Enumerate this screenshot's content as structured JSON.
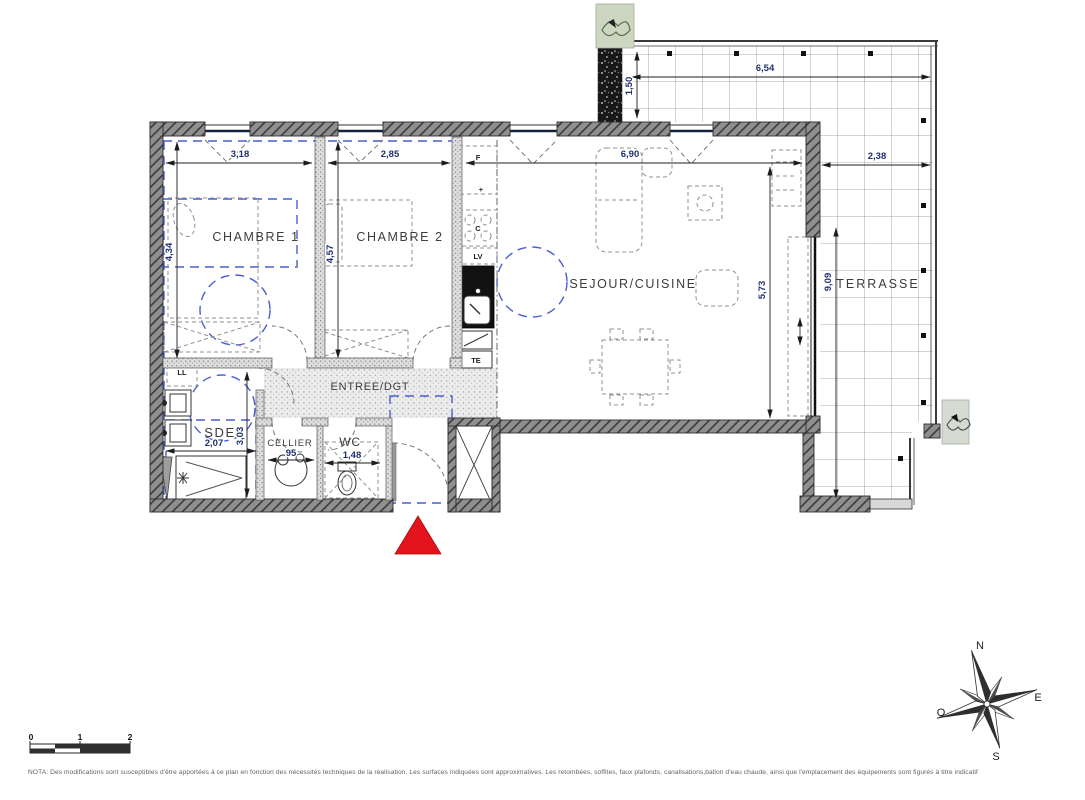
{
  "colors": {
    "wall": "#3a3a3a",
    "dimension_text": "#20306e",
    "accessibility_blue": "#4a5ed2",
    "entrance_marker_red": "#e3131b",
    "terrace_grid": "#8f8f8f"
  },
  "rooms": {
    "chambre1": {
      "label": "CHAMBRE 1",
      "width_m": "3,18",
      "height_m": "4,34"
    },
    "chambre2": {
      "label": "CHAMBRE 2",
      "width_m": "2,85",
      "height_m": "4,57"
    },
    "sejour_cuisine": {
      "label": "SEJOUR/CUISINE",
      "width_m": "6,90",
      "height_m": "5,73"
    },
    "entree": {
      "label": "ENTREE/DGT"
    },
    "sde": {
      "label": "SDE",
      "width_m": "2,07",
      "height_m": "3,03"
    },
    "cellier": {
      "label": "CELLIER",
      "width_cm": "95"
    },
    "wc": {
      "label": "WC",
      "width_m": "1,48"
    },
    "terrasse": {
      "label": "TERRASSE",
      "top_width_m": "6,54",
      "top_depth_m": "1,50",
      "side_width_m": "2,38",
      "side_length_m": "9,09"
    }
  },
  "appliances": {
    "fridge": "F",
    "plus": "+",
    "hob": "C",
    "dishwasher": "LV",
    "electrical_panel": "TE",
    "washing_machine": "LL"
  },
  "compass": {
    "north": "N",
    "east": "E",
    "south": "S",
    "west": "O"
  },
  "scale_bar": {
    "tick0": "0",
    "tick1": "1",
    "tick2": "2"
  },
  "nota": "NOTA: Des modifications sont susceptibles d'être apportées à ce plan en fonction des nécessités techniques de la réalisation. Les surfaces indiquées sont approximatives. Les retombées, soffites, faux plafonds, canalisations,ballon d'eau chaude, ainsi que l'emplacement des équipements sont figurés à titre indicatif"
}
